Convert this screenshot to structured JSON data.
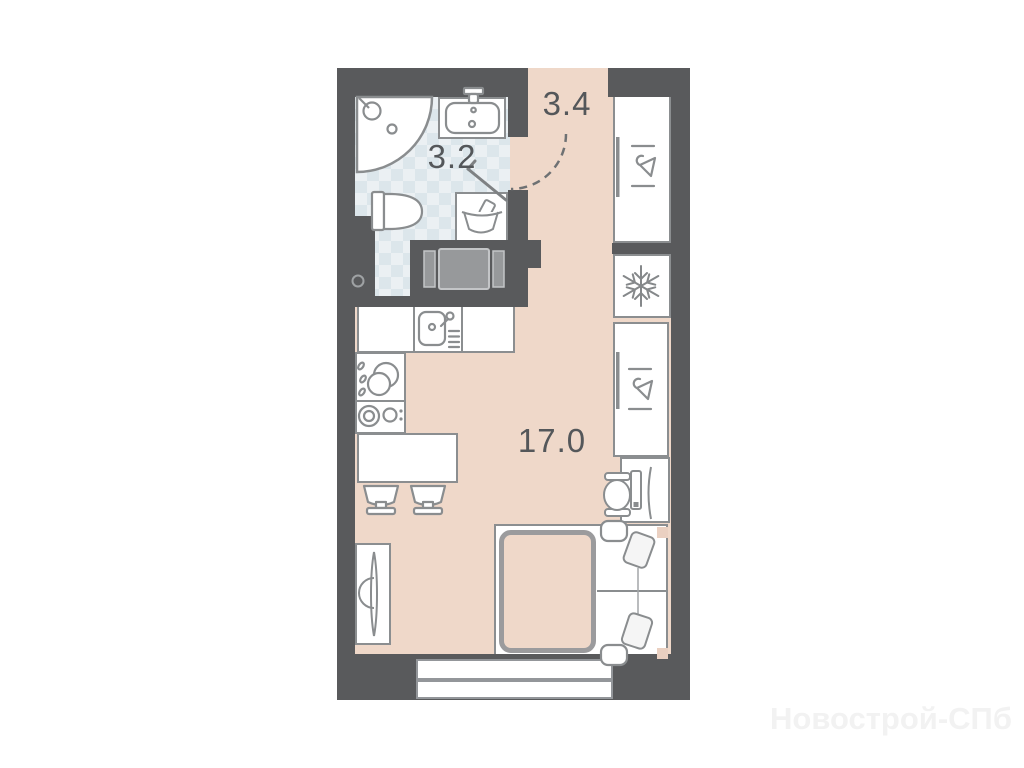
{
  "plan": {
    "watermark": "Новострой-СПб",
    "rooms": [
      {
        "id": "hallway",
        "area_label": "3.4"
      },
      {
        "id": "bathroom",
        "area_label": "3.2"
      },
      {
        "id": "living-room",
        "area_label": "17.0"
      }
    ],
    "colors": {
      "wall": "#595a5c",
      "floor": "#efd8c9",
      "bathroom_tile_base": "#ebf0f3",
      "bathroom_tile_check": "#dce6eb",
      "fixture_line": "#8a8d8f",
      "blanket_line": "#9b9b9d",
      "label_text": "#54575a",
      "watermark_text": "#f2f2f2",
      "background": "#ffffff"
    },
    "icons": [
      "shower-head-icon",
      "drain-icon",
      "sink-icon",
      "toilet-icon",
      "laundry-basket-icon",
      "door-swing-arc",
      "door-leaf",
      "kitchen-sink-icon",
      "water-drops-icon",
      "cooktop-burners-icon",
      "dining-table",
      "stool",
      "tv-icon",
      "hanger-icon",
      "snowflake-icon",
      "desk-chair-icon",
      "monitor-icon",
      "bed",
      "pillow",
      "blanket",
      "window"
    ]
  }
}
